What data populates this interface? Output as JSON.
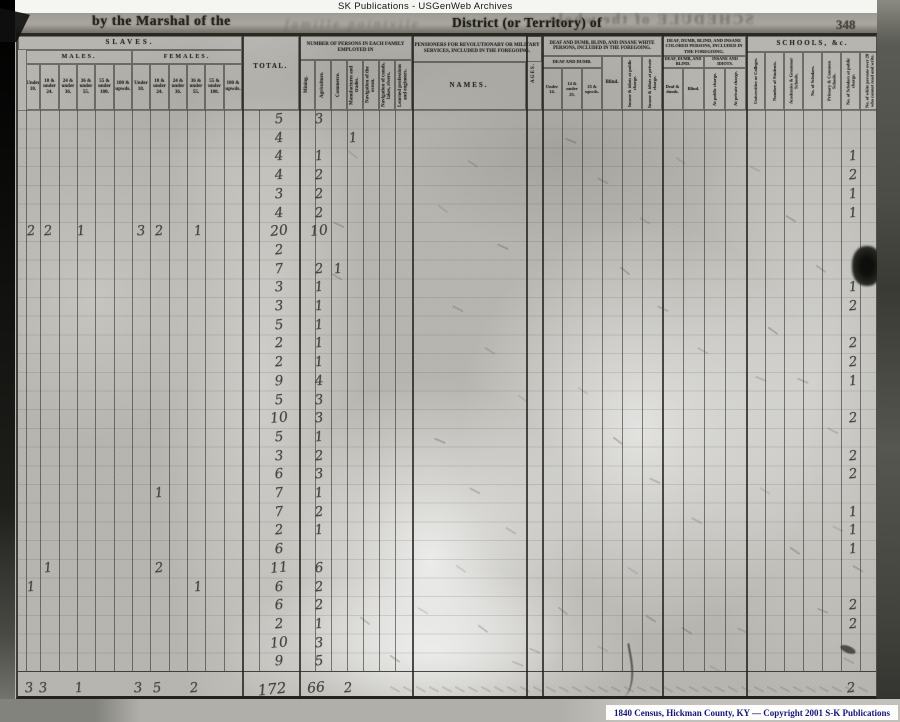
{
  "page": {
    "archive_label": "SK Publications - USGenWeb Archives",
    "page_number": "348",
    "header_line": {
      "printed_prefix": "by the Marshal of the",
      "handwritten_district": "famille pointvile",
      "printed_suffix": "District (or Territory) of",
      "bleedthrough_mirrored": "SCHEDULE of the whole"
    },
    "footer_credit": "1840 Census, Hickman County, KY — Copyright 2001 S-K Publications"
  },
  "form": {
    "slaves": {
      "title": "SLAVES.",
      "males_label": "MALES.",
      "females_label": "FEMALES.",
      "total_label": "TOTAL.",
      "age_columns": [
        "Under 10.",
        "10 & under 24.",
        "24 & under 36.",
        "36 & under 55.",
        "55 & under 100.",
        "100 & upwds."
      ]
    },
    "employment": {
      "title": "NUMBER OF PERSONS IN EACH FAMILY EMPLOYED IN",
      "columns": [
        "Mining.",
        "Agriculture.",
        "Commerce.",
        "Manufactures and trades.",
        "Navigation of the ocean.",
        "Navigation of canals, lakes, rivers.",
        "Learned professions and engineers."
      ]
    },
    "pensioners": {
      "title": "PENSIONERS FOR REVOLUTIONARY OR MILITARY SERVICES, INCLUDED IN THE FOREGOING.",
      "names_label": "NAMES.",
      "ages_label": "AGES."
    },
    "white_impaired": {
      "title": "DEAF AND DUMB, BLIND, AND INSANE WHITE PERSONS, INCLUDED IN THE FOREGOING.",
      "group_deaf": "DEAF AND DUMB.",
      "columns": [
        "Under 14.",
        "14 & under 25.",
        "25 & upwds.",
        "Blind.",
        "Insane & idiots at public charge.",
        "Insane & idiots at private charge."
      ]
    },
    "colored_impaired": {
      "title": "DEAF, DUMB, BLIND, AND INSANE COLORED PERSONS, INCLUDED IN THE FOREGOING.",
      "group_deaf": "DEAF, DUMB, AND BLIND.",
      "group_insane": "INSANE AND IDIOTS.",
      "columns": [
        "Deaf & dumb.",
        "Blind.",
        "At public charge.",
        "At private charge."
      ]
    },
    "schools": {
      "title": "SCHOOLS, &c.",
      "columns": [
        "Universities or Colleges.",
        "Number of Students.",
        "Academies & Grammar Schools.",
        "No. of Scholars.",
        "Primary & Common Schools.",
        "No. of Scholars at public charge.",
        "No. of white persons over 20 who cannot read and write."
      ]
    }
  },
  "handwritten": {
    "family_rows": [
      {
        "total": "5",
        "agriculture": "3"
      },
      {
        "total": "4",
        "manufactures": "1"
      },
      {
        "total": "4",
        "agriculture": "1"
      },
      {
        "total": "4",
        "agriculture": "2"
      },
      {
        "total": "3",
        "agriculture": "2"
      },
      {
        "total": "4",
        "agriculture": "2"
      },
      {
        "total": "20",
        "agriculture": "10"
      },
      {
        "total": "2"
      },
      {
        "total": "7",
        "agriculture": "2",
        "commerce": "1"
      },
      {
        "total": "3",
        "agriculture": "1"
      },
      {
        "total": "3",
        "agriculture": "1"
      },
      {
        "total": "5",
        "agriculture": "1"
      },
      {
        "total": "2",
        "agriculture": "1"
      },
      {
        "total": "2",
        "agriculture": "1"
      },
      {
        "total": "9",
        "agriculture": "4"
      },
      {
        "total": "5",
        "agriculture": "3"
      },
      {
        "total": "10",
        "agriculture": "3"
      },
      {
        "total": "5",
        "agriculture": "1"
      },
      {
        "total": "3",
        "agriculture": "2"
      },
      {
        "total": "6",
        "agriculture": "3"
      },
      {
        "total": "7",
        "agriculture": "1"
      },
      {
        "total": "7",
        "agriculture": "2"
      },
      {
        "total": "2",
        "agriculture": "1"
      },
      {
        "total": "6"
      },
      {
        "total": "11",
        "agriculture": "6"
      },
      {
        "total": "6",
        "agriculture": "2"
      },
      {
        "total": "6",
        "agriculture": "2"
      },
      {
        "total": "2",
        "agriculture": "1"
      },
      {
        "total": "10",
        "agriculture": "3"
      },
      {
        "total": "9",
        "agriculture": "5"
      }
    ],
    "slave_entries": [
      {
        "row": 7,
        "col": "m_under10",
        "value": "2"
      },
      {
        "row": 7,
        "col": "m_10_24",
        "value": "2"
      },
      {
        "row": 7,
        "col": "m_24_36",
        "value": "1"
      },
      {
        "row": 7,
        "col": "f_under10",
        "value": "3"
      },
      {
        "row": 7,
        "col": "f_10_24",
        "value": "2"
      },
      {
        "row": 7,
        "col": "f_36_55",
        "value": "1"
      },
      {
        "row": 21,
        "col": "f_10_24",
        "value": "1"
      },
      {
        "row": 25,
        "col": "m_10_24",
        "value": "1"
      },
      {
        "row": 25,
        "col": "f_10_24",
        "value": "2"
      },
      {
        "row": 26,
        "col": "m_under10",
        "value": "1"
      },
      {
        "row": 26,
        "col": "f_36_55",
        "value": "1"
      }
    ],
    "literacy_entries": [
      {
        "row": 3,
        "value": "1"
      },
      {
        "row": 4,
        "value": "2"
      },
      {
        "row": 5,
        "value": "1"
      },
      {
        "row": 6,
        "value": "1"
      },
      {
        "row": 10,
        "value": "1"
      },
      {
        "row": 11,
        "value": "2"
      },
      {
        "row": 13,
        "value": "2"
      },
      {
        "row": 14,
        "value": "2"
      },
      {
        "row": 15,
        "value": "1"
      },
      {
        "row": 17,
        "value": "2"
      },
      {
        "row": 19,
        "value": "2"
      },
      {
        "row": 20,
        "value": "2"
      },
      {
        "row": 22,
        "value": "1"
      },
      {
        "row": 23,
        "value": "1"
      },
      {
        "row": 24,
        "value": "1"
      },
      {
        "row": 27,
        "value": "2"
      },
      {
        "row": 28,
        "value": "2"
      }
    ],
    "totals_row": {
      "m_under10": "3",
      "m_10_24": "3",
      "m_24_36": "1",
      "f_under10": "3",
      "f_10_24": "5",
      "f_36_55": "2",
      "total": "172",
      "agriculture": "66",
      "manufactures": "2",
      "literacy": "2"
    },
    "below_line_mark": "1"
  },
  "marks": {
    "slashes": [
      [
        350,
        146
      ],
      [
        336,
        216
      ],
      [
        334,
        268
      ],
      [
        470,
        155
      ],
      [
        440,
        200
      ],
      [
        500,
        238
      ],
      [
        455,
        300
      ],
      [
        487,
        342
      ],
      [
        520,
        390
      ],
      [
        437,
        432
      ],
      [
        472,
        482
      ],
      [
        508,
        522
      ],
      [
        458,
        560
      ],
      [
        568,
        132
      ],
      [
        600,
        172
      ],
      [
        642,
        212
      ],
      [
        678,
        152
      ],
      [
        622,
        262
      ],
      [
        660,
        300
      ],
      [
        700,
        342
      ],
      [
        580,
        382
      ],
      [
        615,
        432
      ],
      [
        652,
        472
      ],
      [
        694,
        512
      ],
      [
        630,
        562
      ],
      [
        770,
        322
      ],
      [
        800,
        372
      ],
      [
        830,
        422
      ],
      [
        762,
        482
      ],
      [
        792,
        542
      ],
      [
        820,
        602
      ],
      [
        846,
        652
      ],
      [
        420,
        602
      ],
      [
        392,
        650
      ],
      [
        362,
        612
      ],
      [
        740,
        622
      ],
      [
        712,
        660
      ],
      [
        684,
        622
      ],
      [
        560,
        602
      ],
      [
        532,
        642
      ],
      [
        600,
        640
      ],
      [
        648,
        610
      ],
      [
        480,
        620
      ],
      [
        515,
        655
      ],
      [
        752,
        160
      ],
      [
        788,
        210
      ],
      [
        818,
        260
      ],
      [
        758,
        370
      ],
      [
        835,
        520
      ],
      [
        855,
        560
      ]
    ]
  }
}
